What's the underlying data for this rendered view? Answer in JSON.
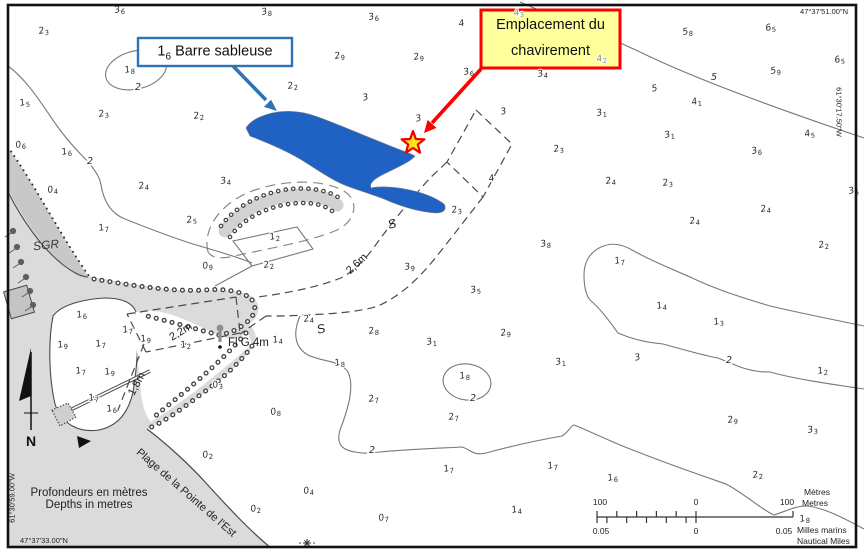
{
  "map": {
    "callouts": {
      "sandbar": {
        "num": "1",
        "sub": "6",
        "text": " Barre sableuse"
      },
      "capsize_line1": "Emplacement du",
      "capsize_line2": "chavirement"
    },
    "coordinates": {
      "top_right": "47°37'51.00\"N",
      "right_edge": "61°30'17.50\"W",
      "left_edge": "61°30'59.00\"W",
      "bottom_left": "47°37'33.00\"N"
    },
    "legend": {
      "depths_fr": "Profondeurs en mètres",
      "depths_en": "Depths in metres"
    },
    "compass": {
      "north": "N"
    },
    "labels": {
      "sgr": "SGR",
      "beach": "Plage de la Pointe de l'Est",
      "light": "Fl G 4m",
      "sand1": "S",
      "sand2": "S",
      "depth_26": "2,6m",
      "depth_22": "2,2m",
      "depth_18": "1,8m"
    },
    "scale_bar": {
      "m_left": "100",
      "m_zero": "0",
      "m_right": "100",
      "metres_fr": "Mètres",
      "metres_en": "Metres",
      "nm_left": "0.05",
      "nm_zero": "0",
      "nm_right": "0.05",
      "nm_fr": "Milles marins",
      "nm_en": "Nautical Miles"
    },
    "colors": {
      "sandbar_blue": "#2061c4",
      "callout_blue_border": "#2e74b5",
      "alert_red": "#ff0000",
      "callout_yellow_fill": "#ffff9c",
      "star_yellow": "#ffe31a",
      "land_gray": "#dbdbdb",
      "dune_gray": "#c8c8c8",
      "contour_gray": "#787878",
      "sounding_green": "#87994a"
    },
    "soundings": [
      [
        "3",
        "6",
        120,
        12
      ],
      [
        "2",
        "3",
        44,
        33
      ],
      [
        "3",
        "8",
        267,
        14
      ],
      [
        "3",
        "6",
        374,
        19
      ],
      [
        "4",
        "",
        462,
        26
      ],
      [
        "5",
        "8",
        688,
        34
      ],
      [
        "6",
        "5",
        771,
        30
      ],
      [
        "3",
        "6",
        469,
        74
      ],
      [
        "3",
        "4",
        543,
        76
      ],
      [
        "5",
        "9",
        776,
        73
      ],
      [
        "6",
        "5",
        840,
        62
      ],
      [
        "2",
        "9",
        340,
        58
      ],
      [
        "2",
        "9",
        419,
        59
      ],
      [
        "1",
        "8",
        130,
        72
      ],
      [
        "1",
        "5",
        25,
        105
      ],
      [
        "2",
        "3",
        104,
        116
      ],
      [
        "2",
        "2",
        199,
        118
      ],
      [
        "2",
        "2",
        293,
        88
      ],
      [
        "3",
        "",
        366,
        100
      ],
      [
        "3",
        "",
        419,
        121
      ],
      [
        "5",
        "",
        655,
        91
      ],
      [
        "4",
        "1",
        697,
        104
      ],
      [
        "3",
        "1",
        602,
        115
      ],
      [
        "3",
        "",
        504,
        114
      ],
      [
        "3",
        "1",
        670,
        137
      ],
      [
        "4",
        "5",
        810,
        136
      ],
      [
        "3",
        "6",
        757,
        153
      ],
      [
        "2",
        "3",
        559,
        151
      ],
      [
        "4",
        "",
        492,
        181
      ],
      [
        "2",
        "4",
        611,
        183
      ],
      [
        "2",
        "3",
        668,
        185
      ],
      [
        "3",
        "5",
        854,
        193
      ],
      [
        "0",
        "6",
        21,
        147
      ],
      [
        "1",
        "6",
        67,
        154
      ],
      [
        "0",
        "4",
        53,
        192
      ],
      [
        "2",
        "4",
        144,
        188
      ],
      [
        "3",
        "4",
        226,
        183
      ],
      [
        "2",
        "5",
        192,
        222
      ],
      [
        "1",
        "7",
        104,
        230
      ],
      [
        "3",
        "8",
        546,
        246
      ],
      [
        "2",
        "4",
        695,
        223
      ],
      [
        "2",
        "4",
        766,
        211
      ],
      [
        "2",
        "2",
        824,
        247
      ],
      [
        "1",
        "7",
        620,
        263
      ],
      [
        "1",
        "4",
        662,
        308
      ],
      [
        "1",
        "3",
        719,
        324
      ],
      [
        "2",
        "9",
        506,
        335
      ],
      [
        "3",
        "1",
        561,
        364
      ],
      [
        "3",
        "",
        638,
        360
      ],
      [
        "1",
        "2",
        823,
        373
      ],
      [
        "0",
        "9",
        208,
        268
      ],
      [
        "1",
        "2",
        275,
        239
      ],
      [
        "2",
        "2",
        269,
        267
      ],
      [
        "2",
        "3",
        457,
        212
      ],
      [
        "3",
        "9",
        410,
        269
      ],
      [
        "3",
        "5",
        476,
        292
      ],
      [
        "1",
        "6",
        82,
        317
      ],
      [
        "1",
        "7",
        128,
        332
      ],
      [
        "1",
        "9",
        63,
        347
      ],
      [
        "1",
        "7",
        101,
        346
      ],
      [
        "1",
        "7",
        81,
        373
      ],
      [
        "1",
        "9",
        110,
        374
      ],
      [
        "1",
        "7",
        94,
        400
      ],
      [
        "1",
        "6",
        112,
        411
      ],
      [
        "1",
        "9",
        146,
        341
      ],
      [
        "1",
        "2",
        186,
        347
      ],
      [
        "2",
        "4",
        309,
        321
      ],
      [
        "1",
        "4",
        278,
        342
      ],
      [
        "1",
        "8",
        340,
        365
      ],
      [
        "0",
        "3",
        218,
        387
      ],
      [
        "0",
        "8",
        276,
        414
      ],
      [
        "0",
        "2",
        208,
        457
      ],
      [
        "0",
        "2",
        256,
        511
      ],
      [
        "0",
        "4",
        309,
        493
      ],
      [
        "0",
        "7",
        384,
        520
      ],
      [
        "2",
        "8",
        374,
        333
      ],
      [
        "3",
        "1",
        432,
        344
      ],
      [
        "2",
        "9",
        733,
        422
      ],
      [
        "1",
        "8",
        465,
        378
      ],
      [
        "2",
        "7",
        374,
        401
      ],
      [
        "2",
        "7",
        454,
        419
      ],
      [
        "1",
        "7",
        449,
        471
      ],
      [
        "1",
        "7",
        553,
        468
      ],
      [
        "1",
        "4",
        517,
        512
      ],
      [
        "3",
        "3",
        813,
        432
      ],
      [
        "1",
        "6",
        613,
        480
      ],
      [
        "2",
        "2",
        758,
        477
      ],
      [
        "1",
        "8",
        805,
        521
      ],
      [
        "4",
        "3",
        519,
        15,
        "g"
      ],
      [
        "4",
        "2",
        602,
        61,
        "gt"
      ]
    ],
    "contour_labels": [
      [
        "2",
        138,
        90
      ],
      [
        "2",
        90,
        164
      ],
      [
        "5",
        714,
        80
      ],
      [
        "2",
        473,
        401
      ],
      [
        "2",
        372,
        453
      ],
      [
        "2",
        729,
        363
      ]
    ]
  }
}
